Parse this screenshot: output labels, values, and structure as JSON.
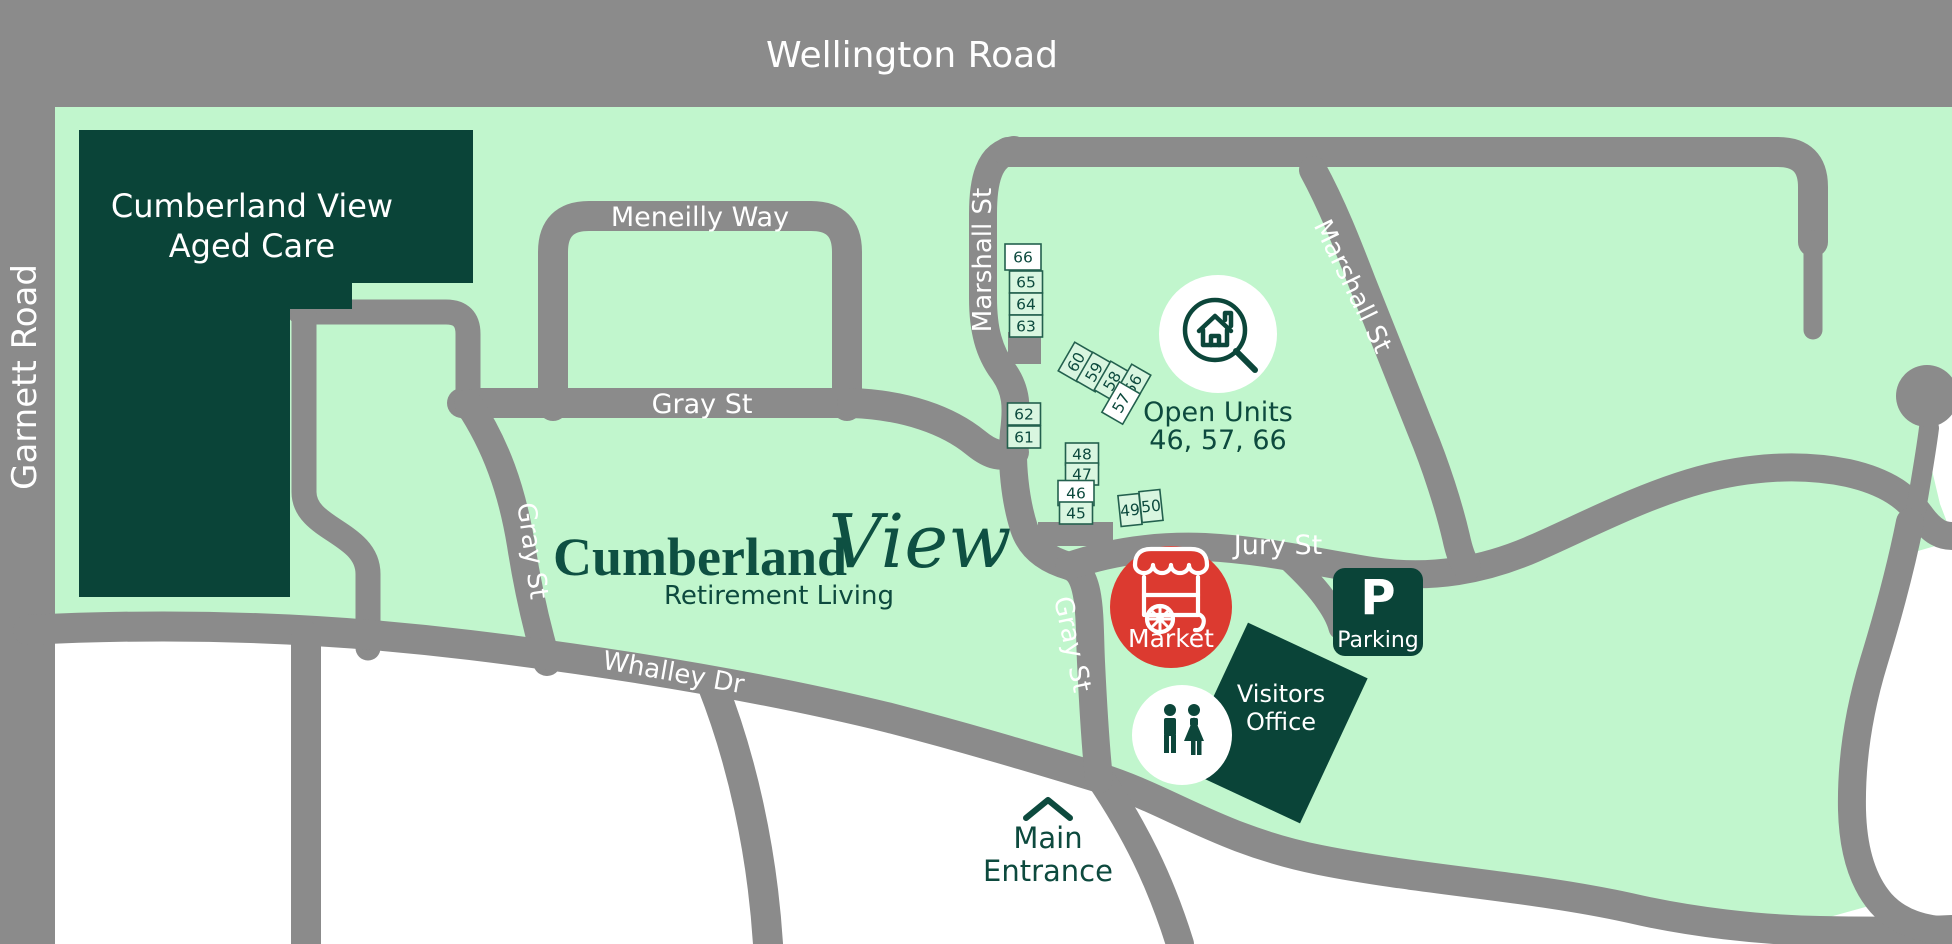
{
  "colors": {
    "road_gray": "#8b8b8b",
    "property_green": "#c1f6cd",
    "dark_green": "#0a4438",
    "market_red": "#dc3a30",
    "white": "#ffffff"
  },
  "roads": {
    "wellington": "Wellington Road",
    "garnett": "Garnett Road",
    "meneilly": "Meneilly Way",
    "gray_main": "Gray St",
    "gray_south": "Gray St",
    "gray_lower": "Gray St",
    "marshall_west": "Marshall St",
    "marshall_east": "Marshall St",
    "jury": "Jury St",
    "whalley": "Whalley Dr"
  },
  "buildings": {
    "aged_care_line1": "Cumberland View",
    "aged_care_line2": "Aged Care",
    "visitors_office_line1": "Visitors",
    "visitors_office_line2": "Office",
    "parking_initial": "P",
    "parking_label": "Parking"
  },
  "landmarks": {
    "open_units_title": "Open Units",
    "open_units_numbers": "46, 57, 66",
    "market": "Market",
    "main_entrance_line1": "Main",
    "main_entrance_line2": "Entrance"
  },
  "logo": {
    "name_serif": "Cumberland",
    "name_script": "View",
    "tagline": "Retirement Living"
  },
  "units": [
    {
      "id": "66",
      "open": true
    },
    {
      "id": "65",
      "open": false
    },
    {
      "id": "64",
      "open": false
    },
    {
      "id": "63",
      "open": false
    },
    {
      "id": "60",
      "open": false
    },
    {
      "id": "59",
      "open": false
    },
    {
      "id": "58",
      "open": false
    },
    {
      "id": "56",
      "open": false
    },
    {
      "id": "57",
      "open": true
    },
    {
      "id": "62",
      "open": false
    },
    {
      "id": "61",
      "open": false
    },
    {
      "id": "48",
      "open": false
    },
    {
      "id": "47",
      "open": false
    },
    {
      "id": "46",
      "open": true
    },
    {
      "id": "45",
      "open": false
    },
    {
      "id": "49",
      "open": false
    },
    {
      "id": "50",
      "open": false
    }
  ]
}
